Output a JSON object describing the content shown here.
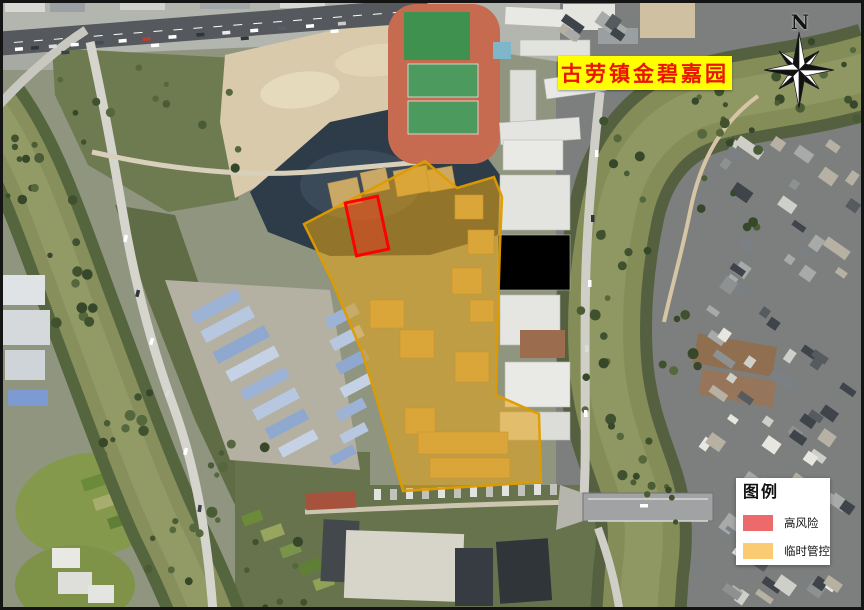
{
  "map": {
    "title": "古劳镇金碧嘉园",
    "title_color": "#EC1400",
    "title_bg": "#FFFF00",
    "compass_label": "N",
    "legend": {
      "title": "图例",
      "items": [
        {
          "id": "high-risk",
          "label": "高风险",
          "color": "#ED6A6C"
        },
        {
          "id": "temporary-control",
          "label": "临时管控",
          "color": "#FACB72"
        }
      ]
    },
    "overlays": {
      "temporary_control": {
        "name": "临时管控",
        "fill": "#E8A414",
        "border": "#DE9B00"
      },
      "high_risk": {
        "name": "高风险",
        "fill": "#FF2A1E",
        "border": "#FF0000"
      }
    }
  }
}
